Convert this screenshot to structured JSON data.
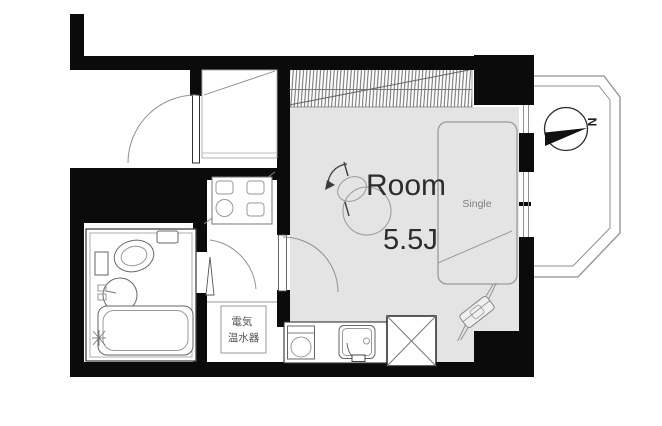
{
  "floor_plan": {
    "room": {
      "label": "Room",
      "size_label": "5.5J"
    },
    "bed": {
      "label": "Single"
    },
    "water_heater": {
      "line1": "電気",
      "line2": "温水器"
    },
    "compass": {
      "north_label": "N"
    },
    "colors": {
      "wall": "#0b0b0b",
      "floor": "#e4e4e4",
      "line": "#909090",
      "text-dark": "#2d2d2d",
      "text-gray": "#7d7d7d"
    },
    "fixtures": [
      "entrance-door",
      "shoe-cabinet",
      "closet",
      "washing-machine-pan",
      "bathroom-door",
      "room-door",
      "toilet",
      "washbasin",
      "bathtub",
      "shower-head",
      "electric-water-heater",
      "kitchen-stove",
      "kitchen-sink",
      "refrigerator-space",
      "single-bed",
      "ceiling-light",
      "air-conditioner",
      "sliding-window",
      "balcony",
      "compass-north"
    ]
  }
}
